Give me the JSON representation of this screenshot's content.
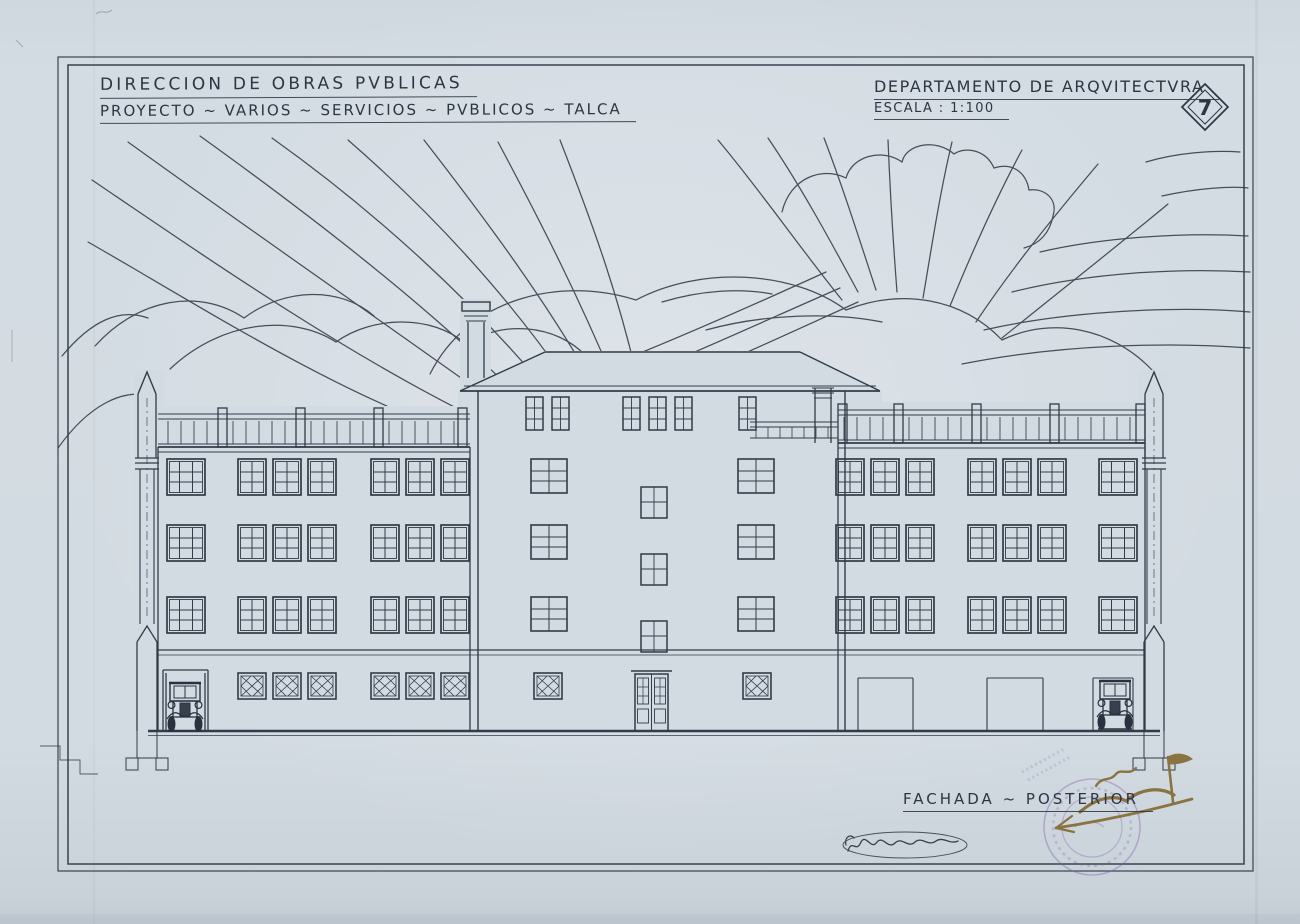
{
  "sheet_number": "7",
  "title_block_left": {
    "line1": "DIRECCION DE OBRAS PVBLICAS",
    "line2": "PROYECTO ~ VARIOS ~ SERVICIOS ~ PVBLICOS ~ TALCA"
  },
  "title_block_right": {
    "line1": "DEPARTAMENTO DE ARQVITECTVRA",
    "line2": "ESCALA : 1:100"
  },
  "caption": "FACHADA ~ POSTERIOR",
  "colors": {
    "paper": "#d3dbe2",
    "ink": "#333b48",
    "sepia_ink": "#8a7340",
    "stamp_purple": "#7d5fb0"
  }
}
